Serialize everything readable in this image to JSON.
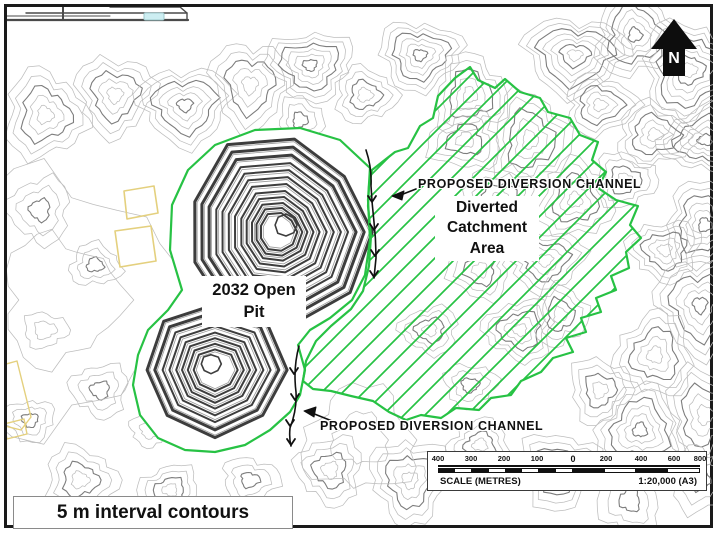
{
  "figure": {
    "north_label": "N",
    "labels": {
      "open_pit": "2032 Open Pit",
      "catchment": "Diverted Catchment Area",
      "channel_top": "PROPOSED DIVERSION CHANNEL",
      "channel_bottom": "PROPOSED DIVERSION CHANNEL",
      "contour_note": "5 m interval contours displayed"
    },
    "scale_bar": {
      "title": "SCALE (METRES)",
      "ratio": "1:20,000 (A3)",
      "ticks": [
        "400",
        "300",
        "200",
        "100",
        "0",
        "200",
        "400",
        "600",
        "800"
      ]
    },
    "colors": {
      "catchment_green": "#27c244",
      "contour_light": "#bdbdbd",
      "contour_index": "#7d7d7d",
      "pit_bench_dark": "#3d3d3d",
      "pit_bench_light": "#9a9a9a",
      "lease_outline_yellow": "#e4d07e",
      "water_cyan": "#cdeef2",
      "structure_gray": "#4a4a4a",
      "arrow_black": "#111111"
    }
  }
}
